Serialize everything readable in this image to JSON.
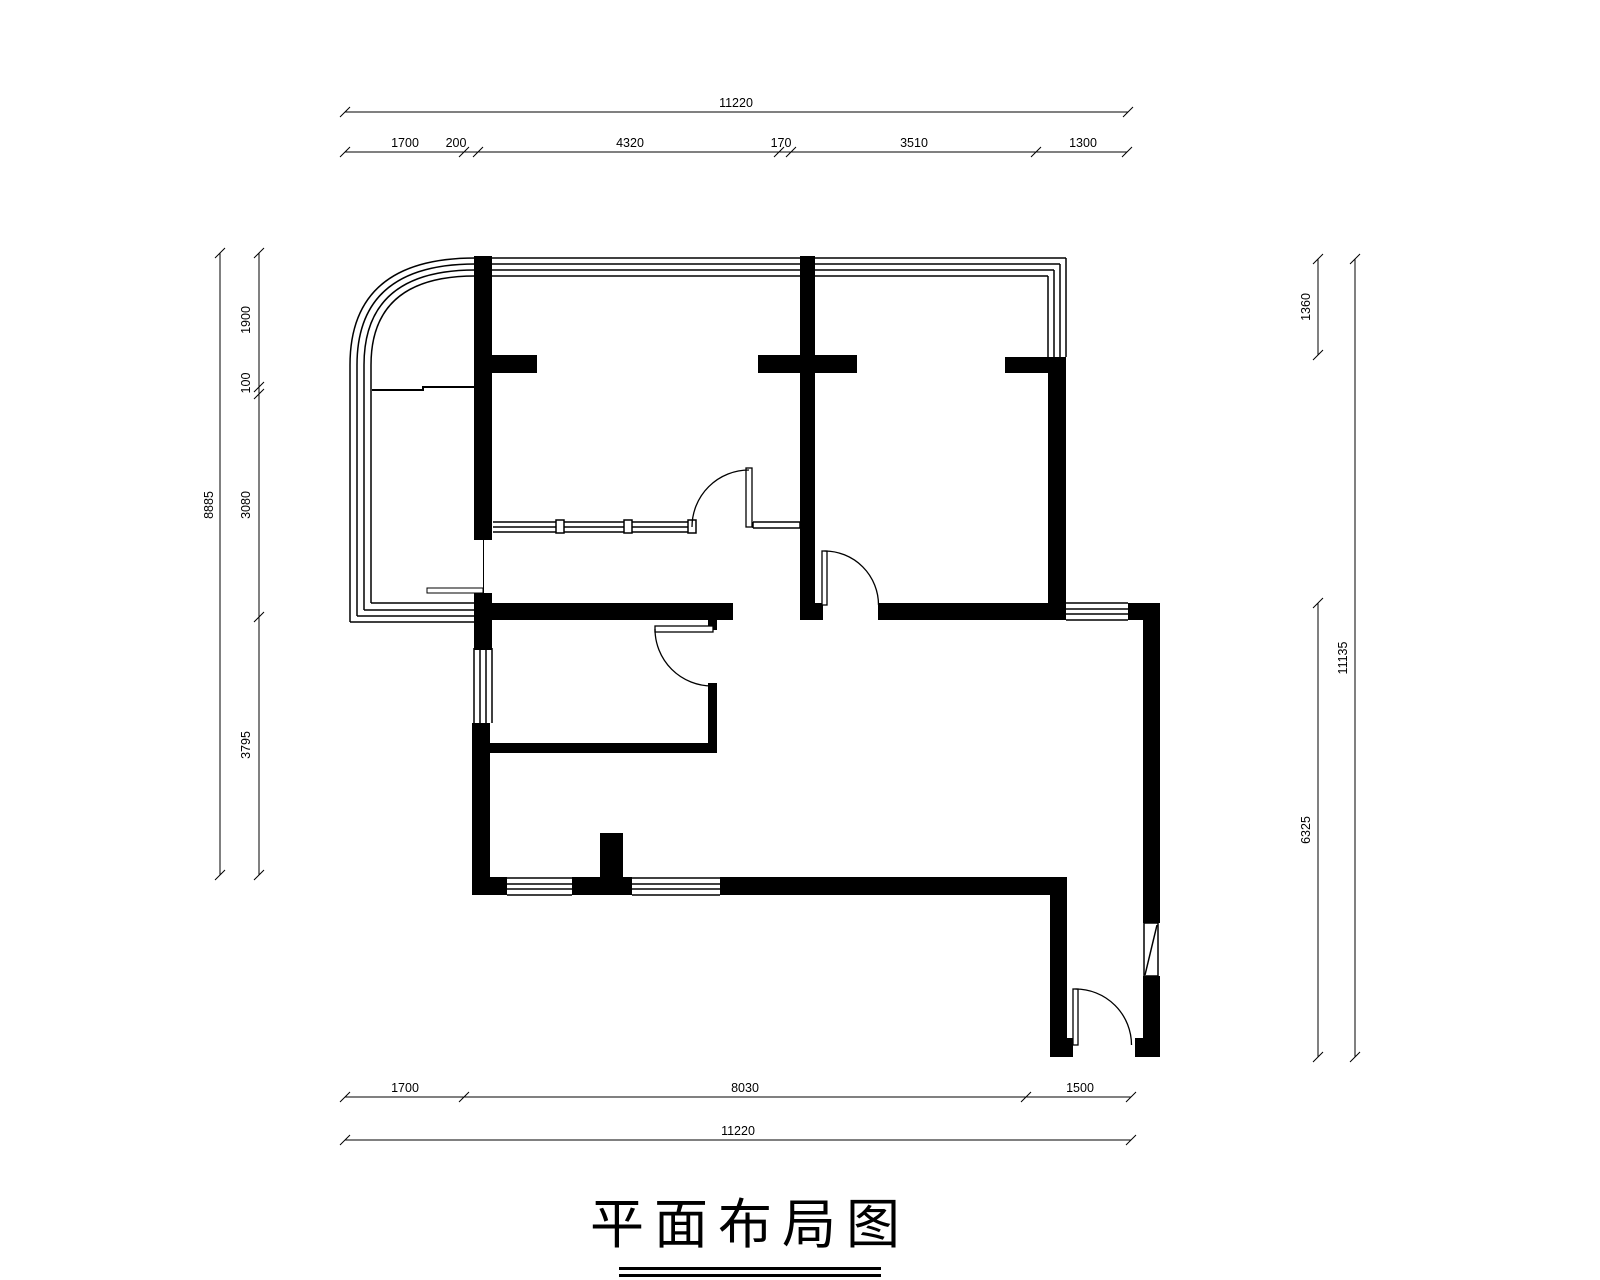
{
  "title": "平面布局图",
  "dims": {
    "top": {
      "total": "11220",
      "segments": [
        "1700",
        "200",
        "4320",
        "170",
        "3510",
        "1300"
      ]
    },
    "bottom": {
      "total": "11220",
      "segments": [
        "1700",
        "8030",
        "1500"
      ]
    },
    "left": {
      "total": "8885",
      "segments": [
        "1900",
        "100",
        "3080",
        "3795"
      ]
    },
    "right": {
      "total": "11135",
      "segments": [
        "1360",
        "6325"
      ]
    }
  },
  "colors": {
    "ink": "#000000",
    "paper": "#ffffff"
  }
}
